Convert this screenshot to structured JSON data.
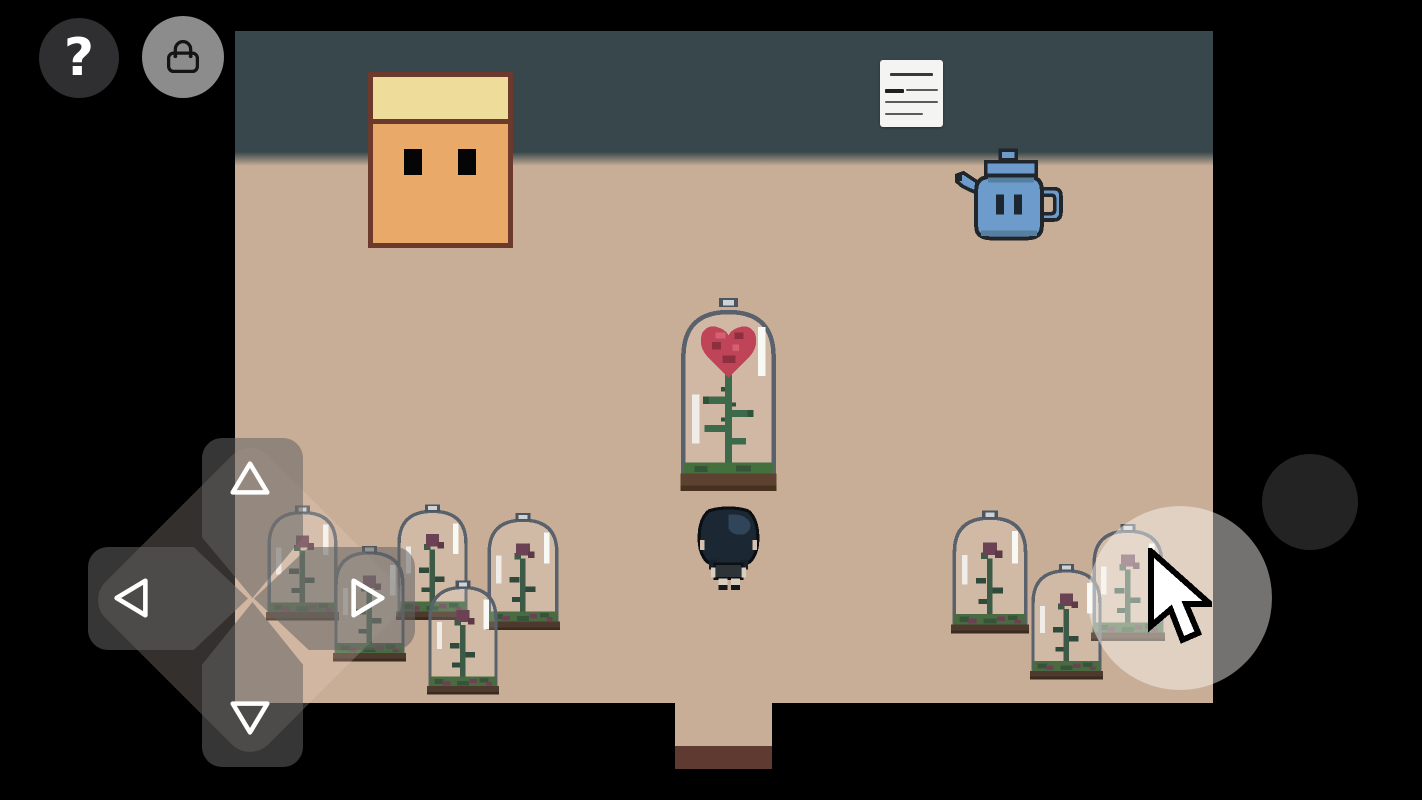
{
  "window": {
    "width": 1422,
    "height": 800,
    "background": "#000000"
  },
  "hud": {
    "help_button": {
      "label": "?",
      "icon": "question-mark-icon",
      "bg": "#2f2f31",
      "fg": "#ffffff"
    },
    "inventory_button": {
      "icon": "handbag-icon",
      "bg": "#8c8c8c",
      "fg": "#1a1a1a"
    },
    "dpad": {
      "buttons": [
        "up",
        "down",
        "left",
        "right"
      ],
      "arrow_style": "white-outline-triangle",
      "button_color": "rgba(98,98,98,0.55)",
      "pad_color": "rgba(235,220,205,0.22)"
    },
    "touch_indicator": {
      "shape": "circle",
      "color": "rgba(255,252,248,0.45)"
    },
    "secondary_button": {
      "shape": "circle",
      "color": "#232323"
    },
    "cursor": {
      "icon": "arrow-cursor-icon",
      "fill": "#ffffff",
      "outline": "#000000"
    }
  },
  "scene": {
    "room": {
      "wall_color": "#37474b",
      "floor_color": "#c9ae97",
      "doorway_rim_color": "#5e3a31"
    },
    "objects": [
      {
        "name": "face-painting",
        "colors": {
          "frame": "#6b3a2c",
          "hair": "#eedc9a",
          "face": "#e9a969",
          "eyes": "#050505"
        }
      },
      {
        "name": "wall-note",
        "paper": "#f4f4f2",
        "text_legible": false,
        "line_count": 4
      },
      {
        "name": "teapot",
        "body": "#6d9bcb",
        "shade": "#55809f",
        "outline": "#20262c"
      },
      {
        "name": "enchanted-rose-dome",
        "rose": "#bf4458",
        "stem": "#3c6a4a",
        "grass": "#44703d",
        "base": "#5d4231",
        "glass_outline": "#59626c"
      },
      {
        "name": "player-character",
        "hair": "#1b2733",
        "hair_highlight": "#31455a",
        "shirt": "#2e3338",
        "limbs": "#d6cfc2"
      },
      {
        "name": "wilted-rose-dome-cluster-left",
        "count": 5,
        "flower": "#6b4254",
        "stem": "#3c5a46",
        "grass": "#4a6b42"
      },
      {
        "name": "wilted-rose-dome-cluster-right",
        "count": 3,
        "flower": "#6b4254",
        "stem": "#3c5a46",
        "grass": "#4a6b42"
      }
    ]
  }
}
